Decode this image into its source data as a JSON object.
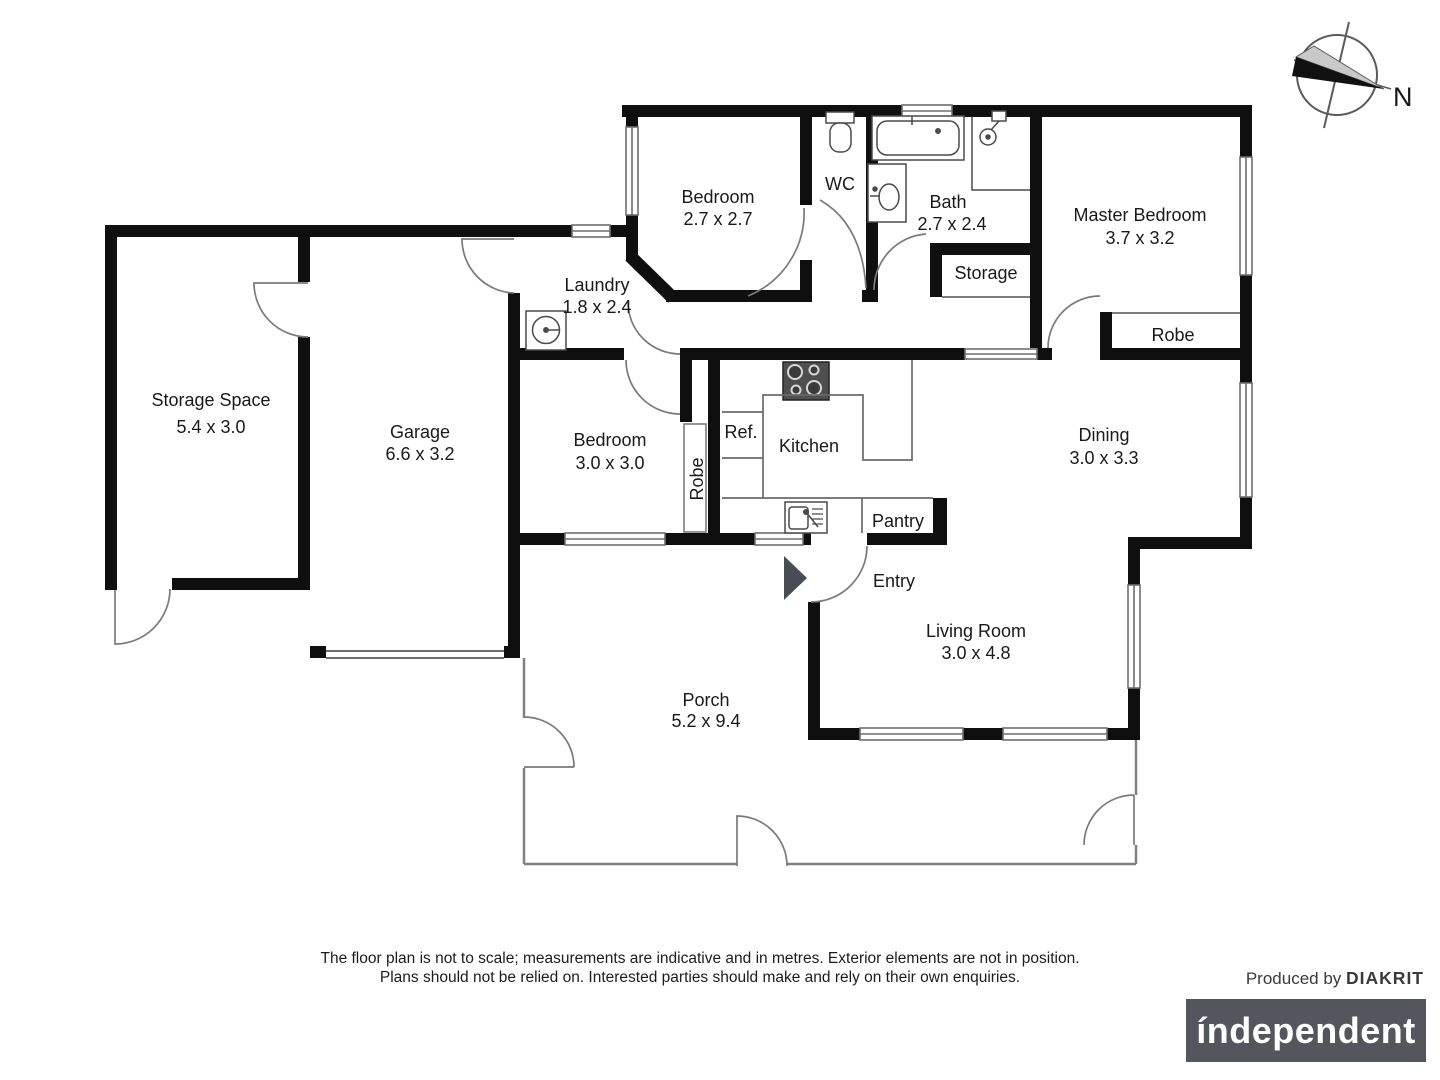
{
  "compass": {
    "label": "N"
  },
  "rooms": {
    "bedroom_top": {
      "name": "Bedroom",
      "dims": "2.7 x 2.7"
    },
    "wc": {
      "name": "WC"
    },
    "bath": {
      "name": "Bath",
      "dims": "2.7 x 2.4"
    },
    "master_bedroom": {
      "name": "Master Bedroom",
      "dims": "3.7 x 3.2"
    },
    "storage": {
      "name": "Storage"
    },
    "robe_master": {
      "name": "Robe"
    },
    "laundry": {
      "name": "Laundry",
      "dims": "1.8 x 2.4"
    },
    "storage_space": {
      "name": "Storage Space",
      "dims": "5.4 x 3.0"
    },
    "garage": {
      "name": "Garage",
      "dims": "6.6 x 3.2"
    },
    "bedroom_mid": {
      "name": "Bedroom",
      "dims": "3.0 x 3.0"
    },
    "robe_bedroom": {
      "name": "Robe"
    },
    "fridge": {
      "name": "Ref."
    },
    "kitchen": {
      "name": "Kitchen"
    },
    "pantry": {
      "name": "Pantry"
    },
    "dining": {
      "name": "Dining",
      "dims": "3.0 x 3.3"
    },
    "entry": {
      "name": "Entry"
    },
    "living_room": {
      "name": "Living Room",
      "dims": "3.0 x 4.8"
    },
    "porch": {
      "name": "Porch",
      "dims": "5.2 x 9.4"
    }
  },
  "footer": {
    "disclaimer_line1": "The floor plan is not to scale; measurements are indicative and in metres. Exterior elements are not in position.",
    "disclaimer_line2": "Plans should not be relied on. Interested parties should make and rely on their own enquiries.",
    "produced_by": "Produced by ",
    "producer": "DIAKRIT",
    "brand": "índependent"
  },
  "colors": {
    "wall": "#0f0f0f",
    "thin_wall": "#808080",
    "logo_bg": "#54565e",
    "logo_text": "#ffffff",
    "entry_arrow": "#474c55"
  }
}
